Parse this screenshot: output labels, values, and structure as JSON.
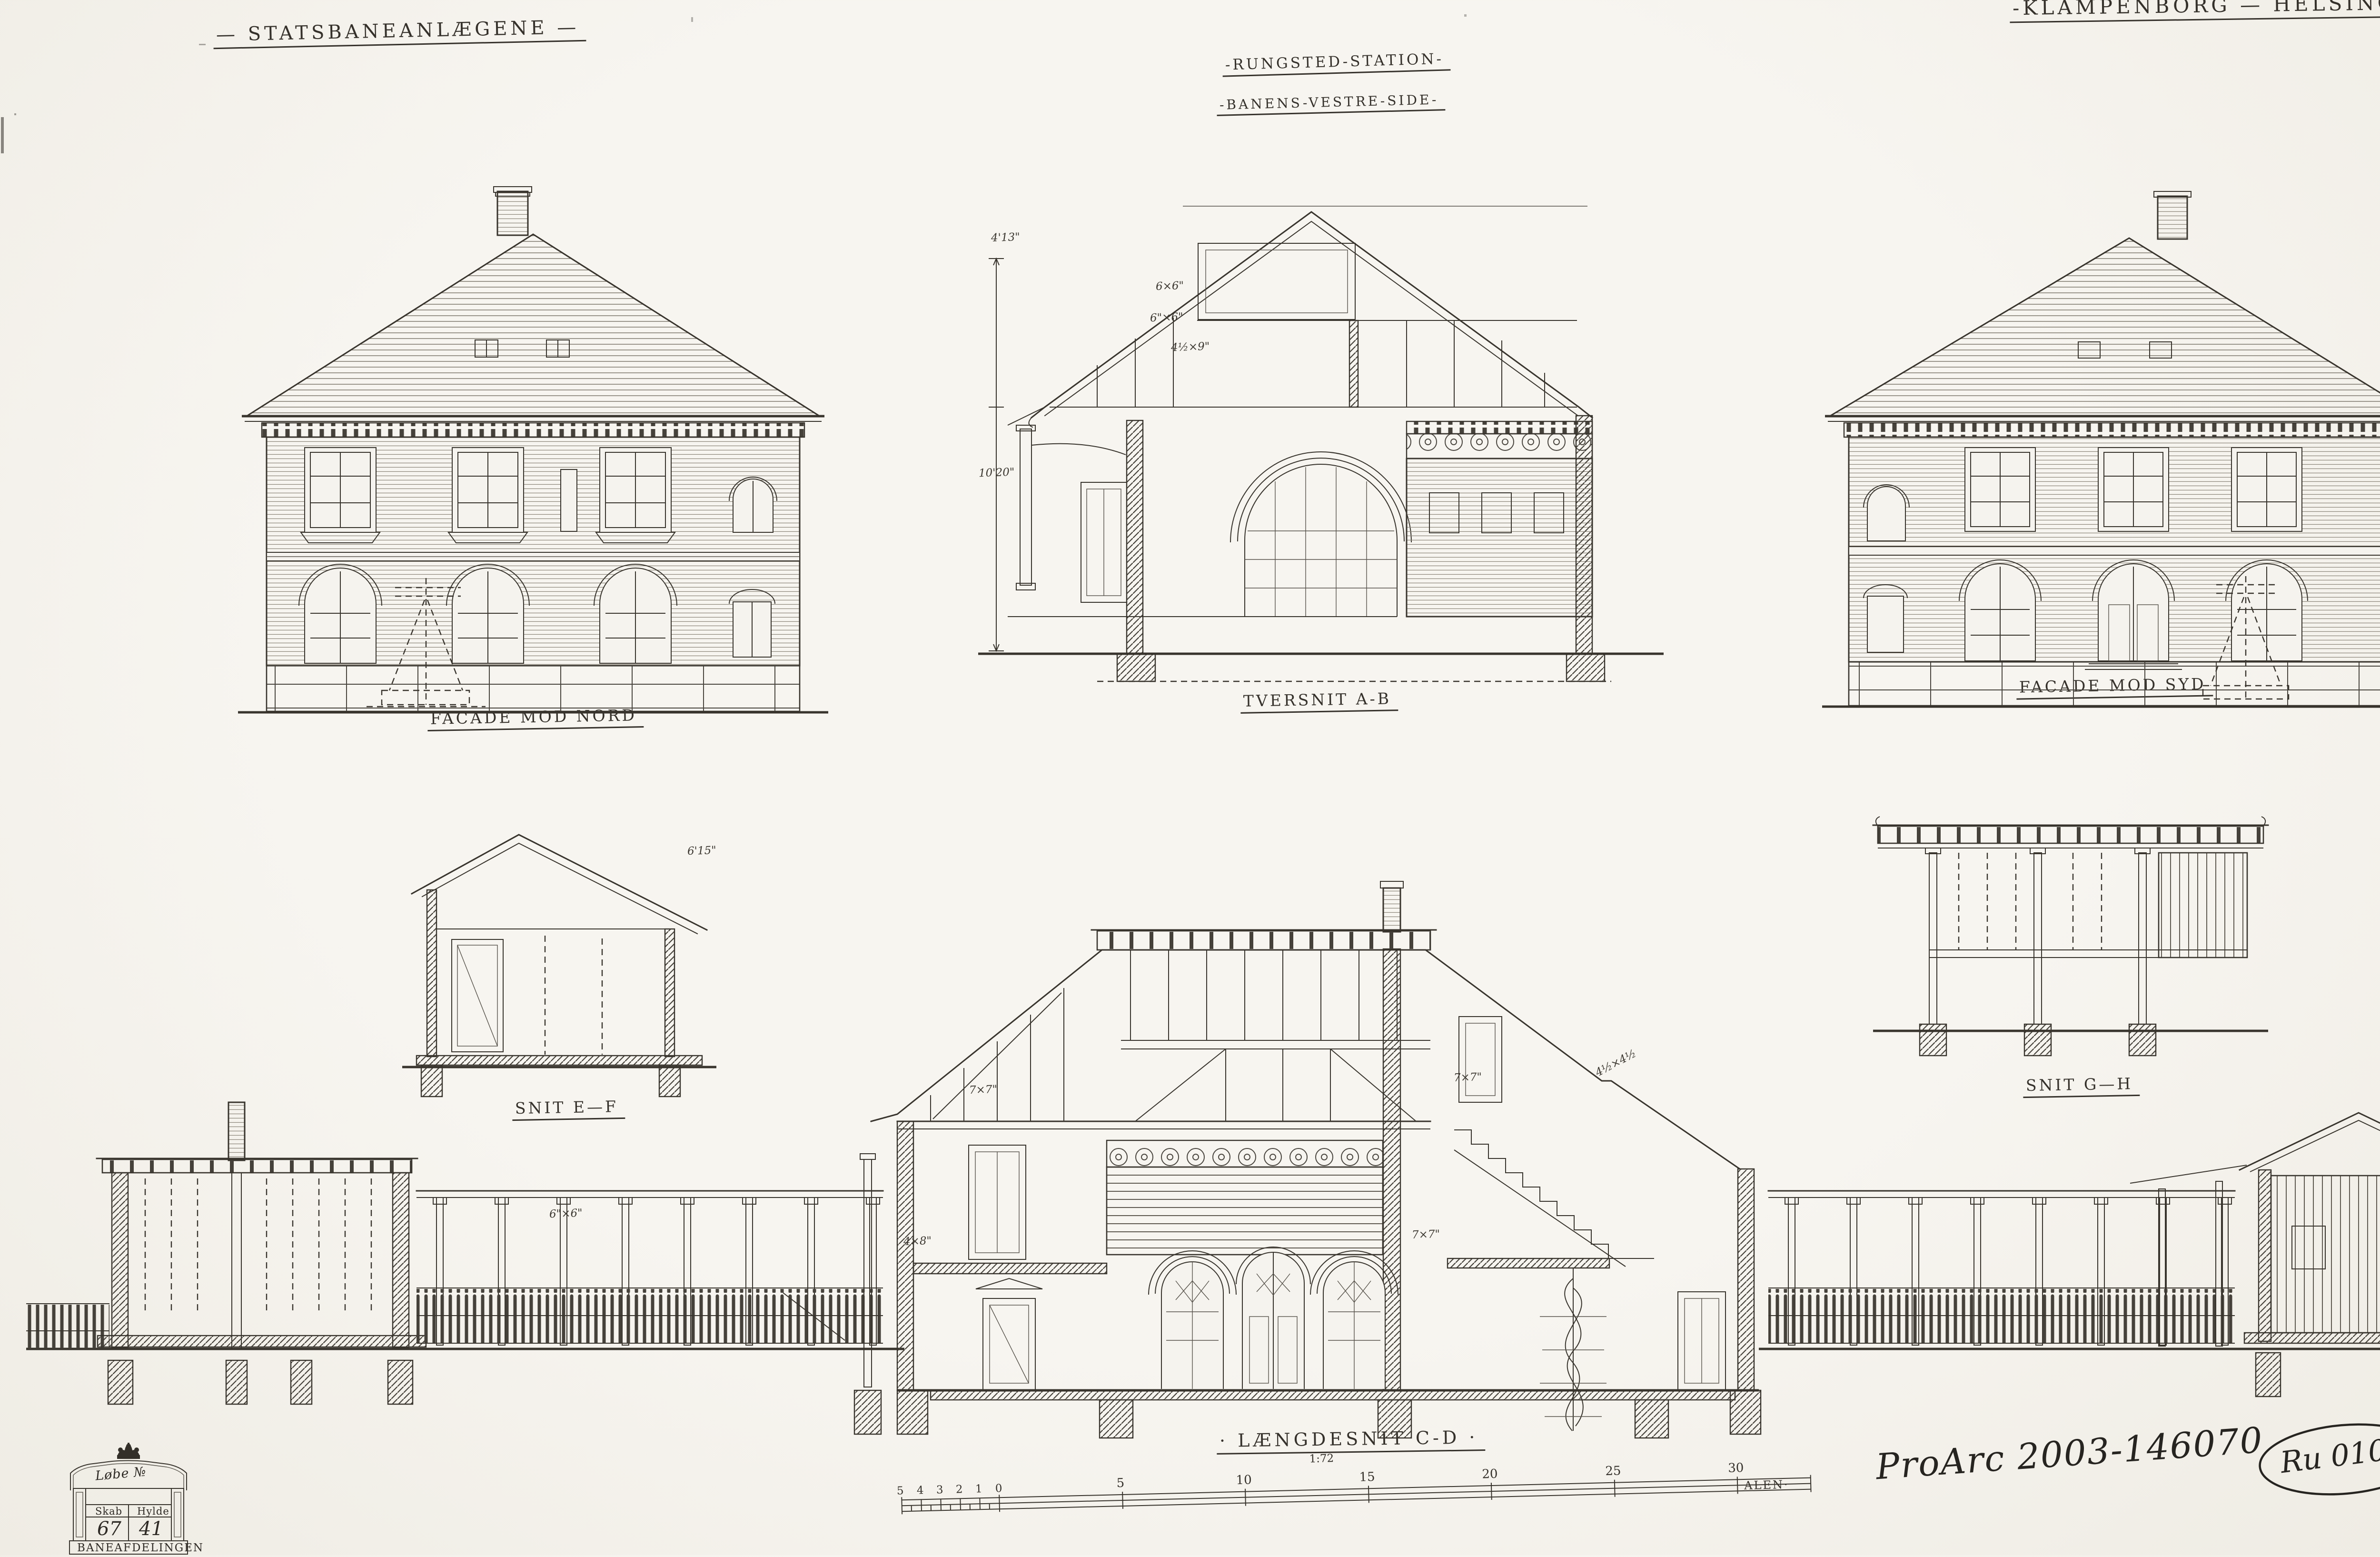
{
  "titles": {
    "project": "— STATSBANEANLÆGENE —",
    "station": "-RUNGSTED-STATION-",
    "side": "-BANENS-VESTRE-SIDE-",
    "line": "-KLAMPENBORG — HELSINGØR"
  },
  "captions": {
    "facade_nord": "FACADE MOD NORD",
    "tversnit": "TVERSNIT A-B",
    "facade_syd": "FACADE MOD SYD",
    "snit_ef": "SNIT E—F",
    "snit_gh": "SNIT G—H",
    "laengdesnit": "· LÆNGDESNIT C-D ·"
  },
  "dims": {
    "d1": "4'13\"",
    "d2": "10'20\"",
    "d4": "6×6\"",
    "d5": "6\"×6\"",
    "d6": "4½×9\"",
    "d7": "7×7\"",
    "d8": "7×7\"",
    "d9": "4×8\"",
    "d10": "4½×4½",
    "d11": "6\"×6\"",
    "d12": "6'15\"",
    "d13": "7×7\""
  },
  "scale_bar": {
    "ratio": "1:72",
    "unit": "ALEN·",
    "minor": [
      "5",
      "4",
      "3",
      "2",
      "1",
      "0"
    ],
    "major": [
      "5",
      "10",
      "15",
      "20",
      "25",
      "30"
    ]
  },
  "ruler": {
    "ratio": "1:72",
    "unit": "ALEN",
    "labels": [
      "30",
      "25",
      "20",
      "15",
      "10",
      "5"
    ]
  },
  "stamp": {
    "script": "Løbe №",
    "col1_label": "Skab",
    "col2_label": "Hylde",
    "col1_value": "67",
    "col2_value": "41",
    "footer": "BANEAFDELINGEN"
  },
  "notes": {
    "archive": "ProArc 2003-146070",
    "ref": "Ru 010-1",
    "date": "i Oktober 1895"
  }
}
